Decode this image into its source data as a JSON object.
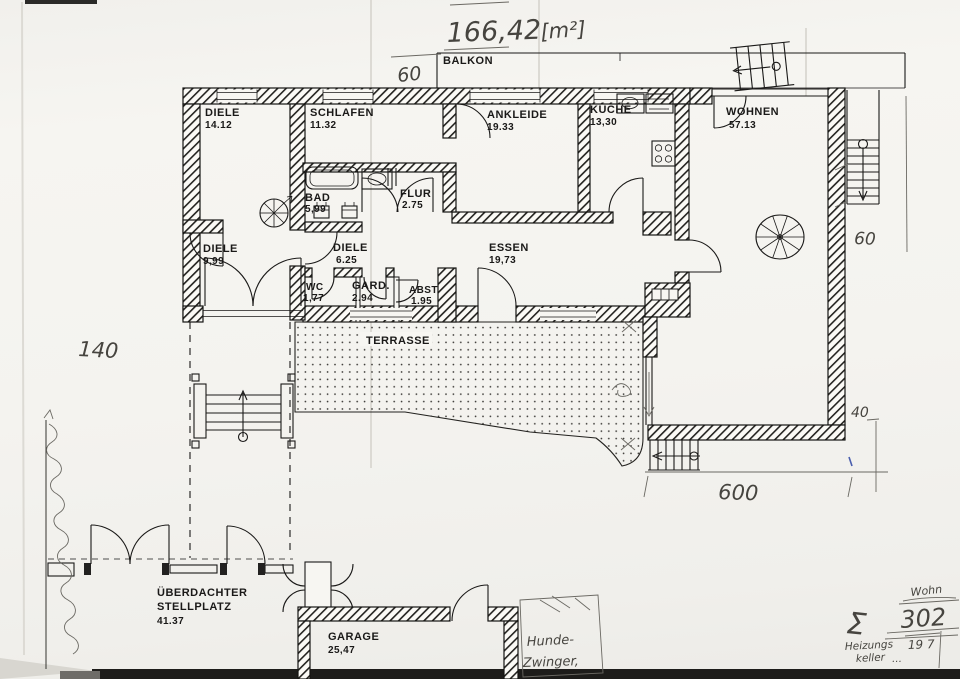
{
  "colors": {
    "ink": "#1a1918",
    "pencil": "#55524d",
    "paper": "#f5f4f0",
    "blue_pen": "#4a5fae"
  },
  "rooms": {
    "balkon": {
      "name": "BALKON"
    },
    "diele_top": {
      "name": "DIELE",
      "area": "14.12"
    },
    "schlafen": {
      "name": "SCHLAFEN",
      "area": "11.32"
    },
    "ankleide": {
      "name": "ANKLEIDE",
      "area": "19.33"
    },
    "kueche": {
      "name": "KÜCHE",
      "area": "13,30"
    },
    "wohnen": {
      "name": "WOHNEN",
      "area": "57.13"
    },
    "bad": {
      "name": "BAD",
      "area": "5,99"
    },
    "flur": {
      "name": "FLUR",
      "area": "2.75"
    },
    "diele_mid": {
      "name": "DIELE",
      "area": "9,99"
    },
    "diele_cor": {
      "name": "DIELE",
      "area": "6.25"
    },
    "essen": {
      "name": "ESSEN",
      "area": "19,73"
    },
    "wc": {
      "name": "WC",
      "area": "1,77"
    },
    "gard": {
      "name": "GARD.",
      "area": "2.94"
    },
    "abst": {
      "name": "ABST.",
      "area": "1.95"
    },
    "terrasse": {
      "name": "TERRASSE"
    },
    "stellplatz": {
      "name_line1": "ÜBERDACHTER",
      "name_line2": "STELLPLATZ",
      "area": "41.37"
    },
    "garage": {
      "name": "GARAGE",
      "area": "25,47"
    }
  },
  "handwritten": {
    "total_area_value": "166,42",
    "total_area_unit": "[m²]",
    "dim_top": "60",
    "dim_left": "140",
    "dim_right": "60",
    "dim_right_lower": "40",
    "dim_bottom": "600",
    "kennel_line1": "Hunde-",
    "kennel_line2": "Zwinger,",
    "wohn_label": "Wohn",
    "sum_sigma": "Σ",
    "sum_value": "302",
    "heating_line1": "Heizungs",
    "heating_line2": "keller",
    "heating_dots": "…",
    "heating_value": "19 7"
  }
}
